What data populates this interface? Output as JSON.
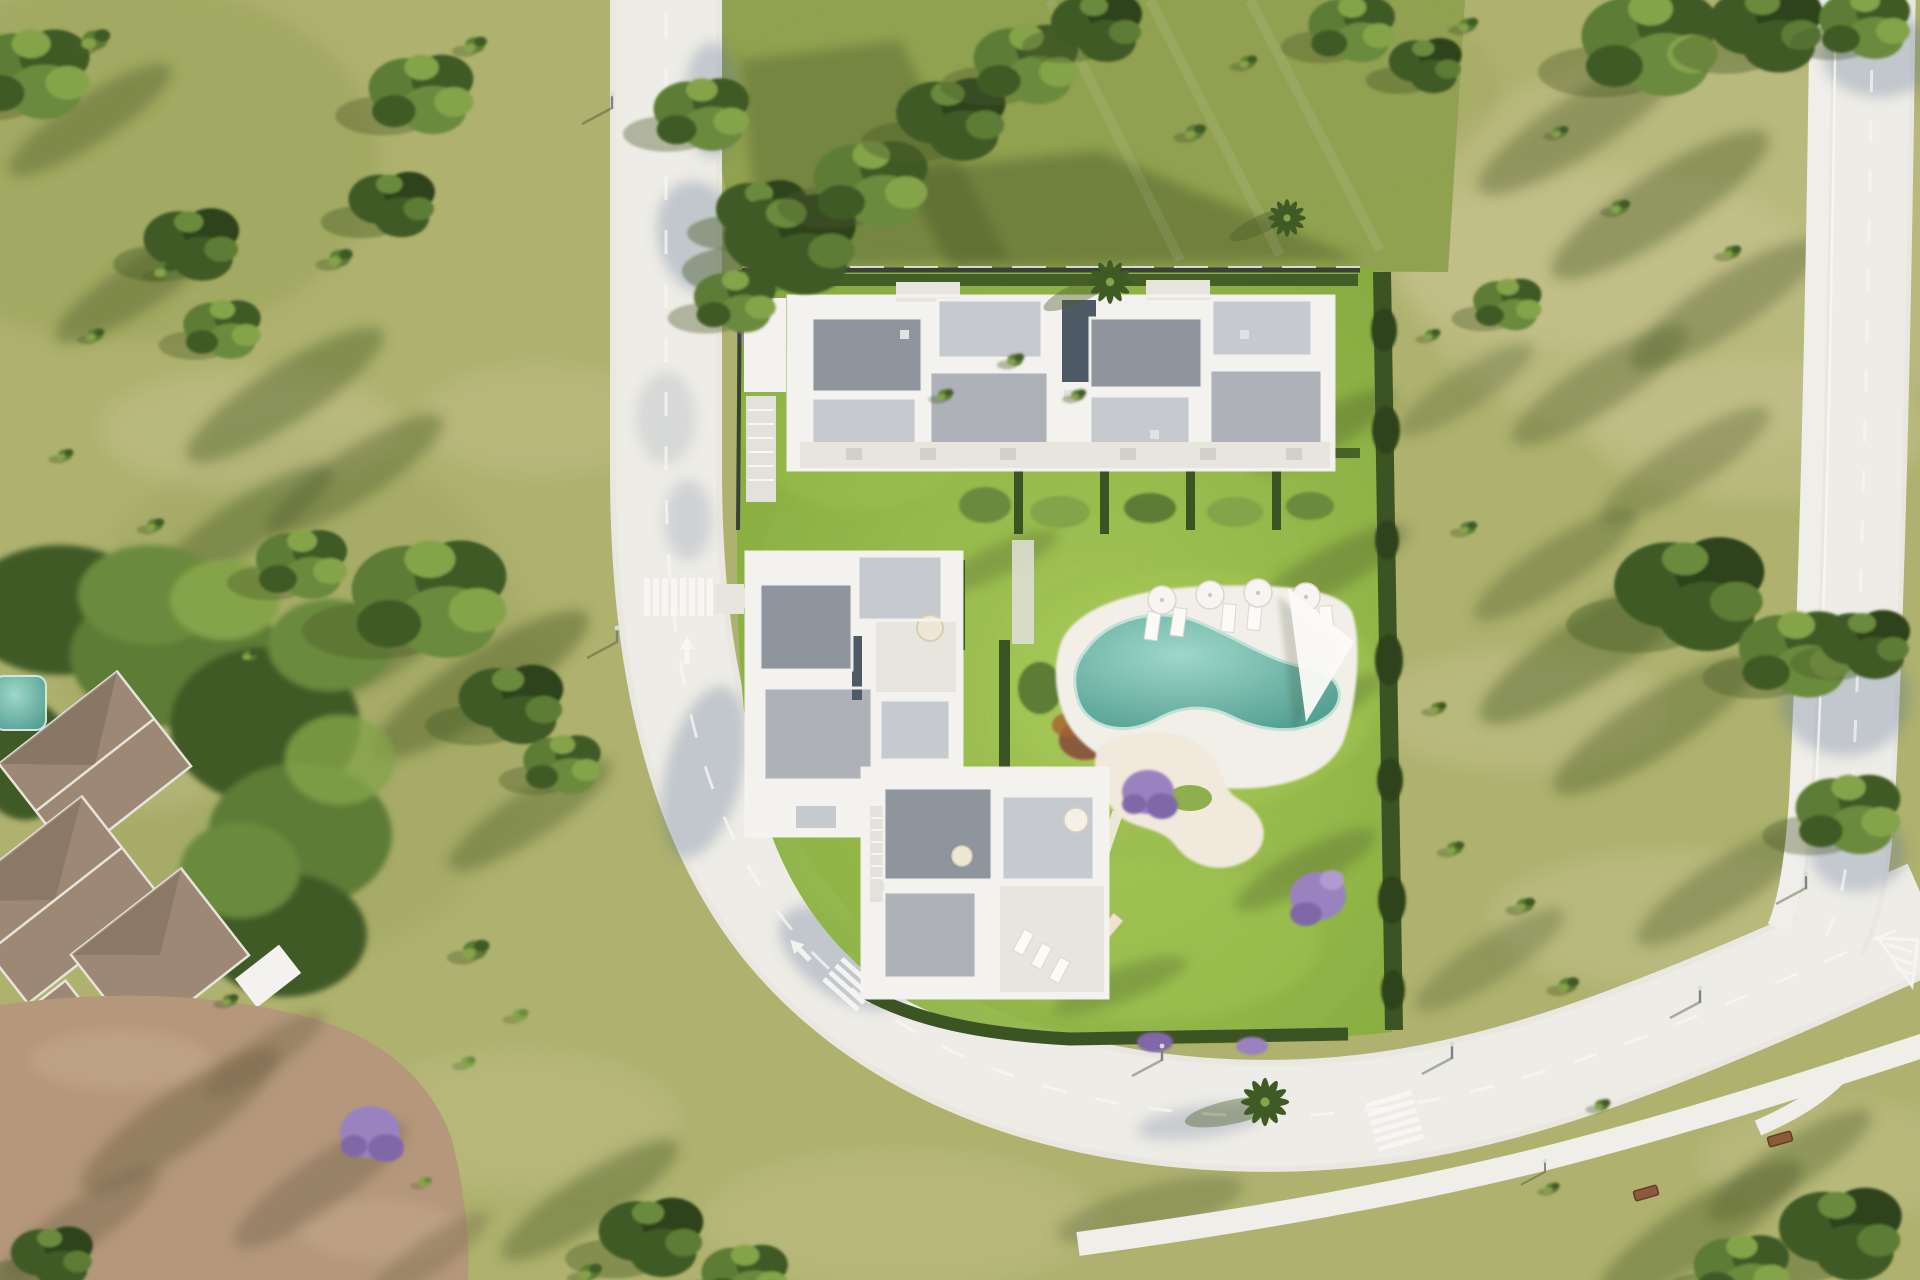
{
  "scene": {
    "description": "Aerial top-down architectural render of a modern residential development: three white flat-roof apartment buildings around a communal garden with an organic-shaped turquoise pool, sun loungers and parasols, a sandy play area with purple jacaranda trees, enclosed by hedges; a curved asphalt road with zebra crossings and lane arrows wraps the plot, a second road runs along the right edge, an existing tiled-roof villa with mature trees and a dirt yard sits bottom-left, all surrounded by olive-green golf-course grass dotted with trees and long shadows.",
    "elements": {
      "development_site": [
        "building-a-north",
        "building-b-west",
        "building-c-south",
        "swimming-pool",
        "pool-deck",
        "shade-sail",
        "sun-loungers",
        "parasols",
        "play-area",
        "garden-hedges",
        "perimeter-wall",
        "palm-trees"
      ],
      "roads": [
        "curved-main-road",
        "right-road",
        "footpath"
      ],
      "road_markings": [
        "zebra-crossing-left",
        "zebra-crossing-curve",
        "zebra-crossing-bottom",
        "lane-arrows",
        "dashed-center-lines",
        "hatched-island"
      ],
      "street_furniture": [
        "streetlights",
        "benches"
      ],
      "neighbour": [
        "villa-tiled-roofs",
        "villa-terrace",
        "villa-umbrellas",
        "villa-small-pool",
        "dirt-yard",
        "jacaranda-tree"
      ],
      "vegetation": [
        "scattered-trees",
        "bushes",
        "tree-shadows"
      ]
    },
    "counts": {
      "buildings_in_site": 3,
      "zebra_crossings": 3,
      "lane_arrows": 4,
      "parasols_at_pool": 4,
      "benches": 2,
      "palms": 3
    }
  },
  "palette": {
    "grassBase": "#aeb26e",
    "grassLight": "#c9c393",
    "grassDark": "#96a058",
    "bandGreen": "#90a150",
    "lawn": "#83a83d",
    "lawnBright": "#a3c853",
    "hedge": "#3c5424",
    "hedgeDark": "#2e431c",
    "treeDark": "#405a26",
    "treeMid": "#5d7c36",
    "treeMid2": "#6a8a3c",
    "treeLight": "#85a34a",
    "shadowOlive": "#4a5c28",
    "road": "#e9e7e0",
    "roadTop": "#eeece6",
    "walk": "#f0eee8",
    "roadShadow": "#5b6f92",
    "marking": "#f8f7f3",
    "curb": "#d8d5ce",
    "wallDark": "#3a4038",
    "buildingWhite": "#f3f2ef",
    "roofLight": "#c6c9cd",
    "roofMid": "#aeb2b8",
    "roofDark": "#8f959d",
    "glassDark": "#4e5a66",
    "terrace": "#e8e5de",
    "stair": "#e2e1db",
    "poolDeep": "#4f9c8e",
    "poolLight": "#9ed7c9",
    "deck": "#f2efe8",
    "sand": "#f0e9dc",
    "dirt": "#b5987c",
    "dirtLight": "#c8ab8c",
    "dirtShadow": "#6e6243",
    "tileRoof": "#9c8875",
    "tileRoofDark": "#82705f",
    "ridge": "#e8e4dc",
    "purple": "#9a82c0",
    "purpleDark": "#8068a8",
    "bench": "#8a5a3a",
    "pole": "#7e8284"
  }
}
